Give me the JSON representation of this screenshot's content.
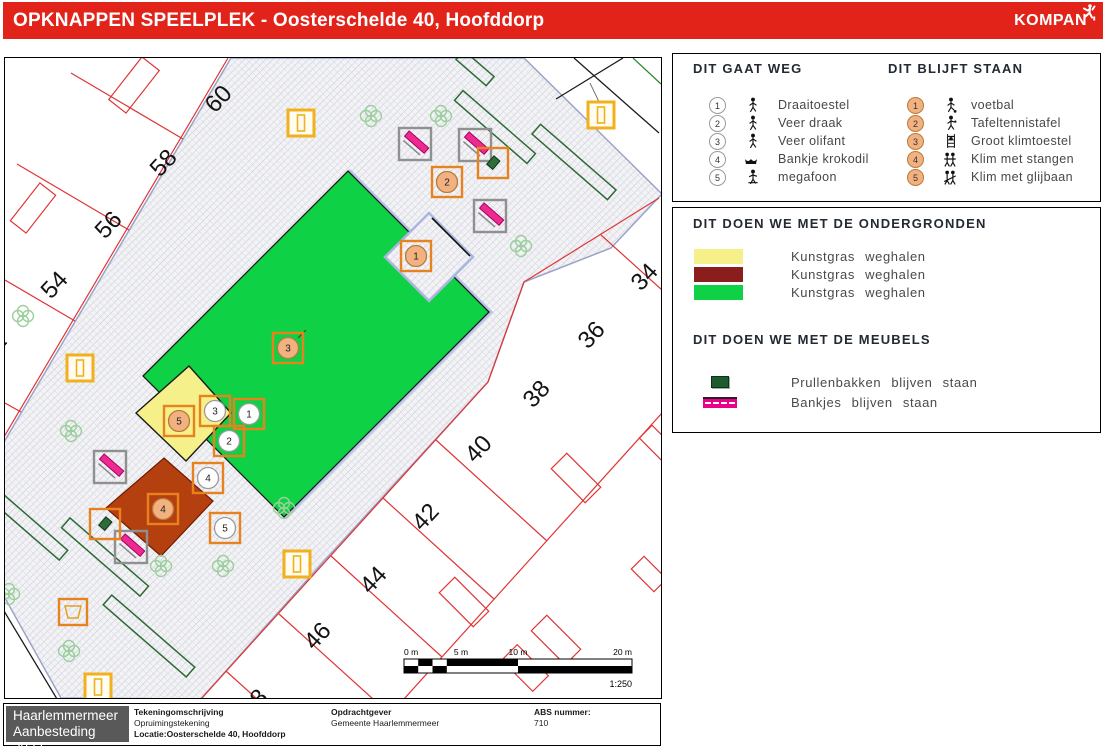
{
  "header": {
    "title": "OPKNAPPEN SPEELPLEK - Oosterschelde 40, Hoofddorp",
    "logo": "KOMPAN"
  },
  "colors": {
    "header_red": "#e2231a",
    "surface_green": "#0ed145",
    "surface_yellow": "#f5f08a",
    "surface_darkred": "#8b1d1d",
    "map_red_orange": "#b5400f",
    "bench_pink": "#ec1e8e",
    "marker_orange": "#e8821e",
    "lamp_yellow": "#f2b01c",
    "blijft_circle_fill": "#f2b180"
  },
  "legend_weg": {
    "title": "DIT GAAT WEG",
    "items": [
      {
        "n": "1",
        "label": "Draaitoestel",
        "icon": "carousel-icon"
      },
      {
        "n": "2",
        "label": "Veer draak",
        "icon": "spring-dragon-icon"
      },
      {
        "n": "3",
        "label": "Veer olifant",
        "icon": "spring-elephant-icon"
      },
      {
        "n": "4",
        "label": "Bankje krokodil",
        "icon": "crocodile-bench-icon"
      },
      {
        "n": "5",
        "label": "megafoon",
        "icon": "megaphone-icon"
      }
    ]
  },
  "legend_blijft": {
    "title": "DIT BLIJFT STAAN",
    "items": [
      {
        "n": "1",
        "label": "voetbal",
        "icon": "football-icon"
      },
      {
        "n": "2",
        "label": "Tafeltennistafel",
        "icon": "table-tennis-icon"
      },
      {
        "n": "3",
        "label": "Groot klimtoestel",
        "icon": "climbing-frame-icon"
      },
      {
        "n": "4",
        "label": "Klim met stangen",
        "icon": "climb-bars-icon"
      },
      {
        "n": "5",
        "label": "Klim met glijbaan",
        "icon": "climb-slide-icon"
      }
    ]
  },
  "ondergronden": {
    "title": "DIT DOEN WE MET DE ONDERGRONDEN",
    "rows": [
      {
        "color": "#f5f08a",
        "label": "Kunstgras weghalen"
      },
      {
        "color": "#8b1d1d",
        "label": "Kunstgras weghalen"
      },
      {
        "color": "#0ed145",
        "label": "Kunstgras weghalen"
      }
    ]
  },
  "meubels": {
    "title": "DIT DOEN WE MET DE MEUBELS",
    "rows": [
      {
        "icon": "trash-bin-icon",
        "label": "Prullenbakken blijven staan"
      },
      {
        "icon": "bench-icon",
        "label": "Bankjes blijven staan"
      }
    ]
  },
  "map": {
    "parcels_tl": [
      "60",
      "58",
      "56",
      "54",
      "2"
    ],
    "parcels_br": [
      "34",
      "36",
      "38",
      "40",
      "42",
      "44",
      "46",
      "8"
    ],
    "markers_weg": [
      "1",
      "2",
      "3",
      "4",
      "5"
    ],
    "markers_blijft": [
      "1",
      "2",
      "3",
      "4",
      "5"
    ],
    "scale": {
      "labels": [
        "0 m",
        "5 m",
        "10 m",
        "20 m"
      ],
      "ratio": "1:250"
    }
  },
  "titleblock": {
    "org_line1": "Haarlemmermeer",
    "org_line2": "Aanbesteding 2023",
    "col1_header": "Tekeningomschrijving",
    "col1_line1": "Opruimingstekening",
    "col1_line2": "Locatie:Oosterschelde 40, Hoofddorp",
    "col2_header": "Opdrachtgever",
    "col2_line1": "Gemeente Haarlemmermeer",
    "col3_header": "ABS nummer:",
    "col3_line1": "710"
  }
}
